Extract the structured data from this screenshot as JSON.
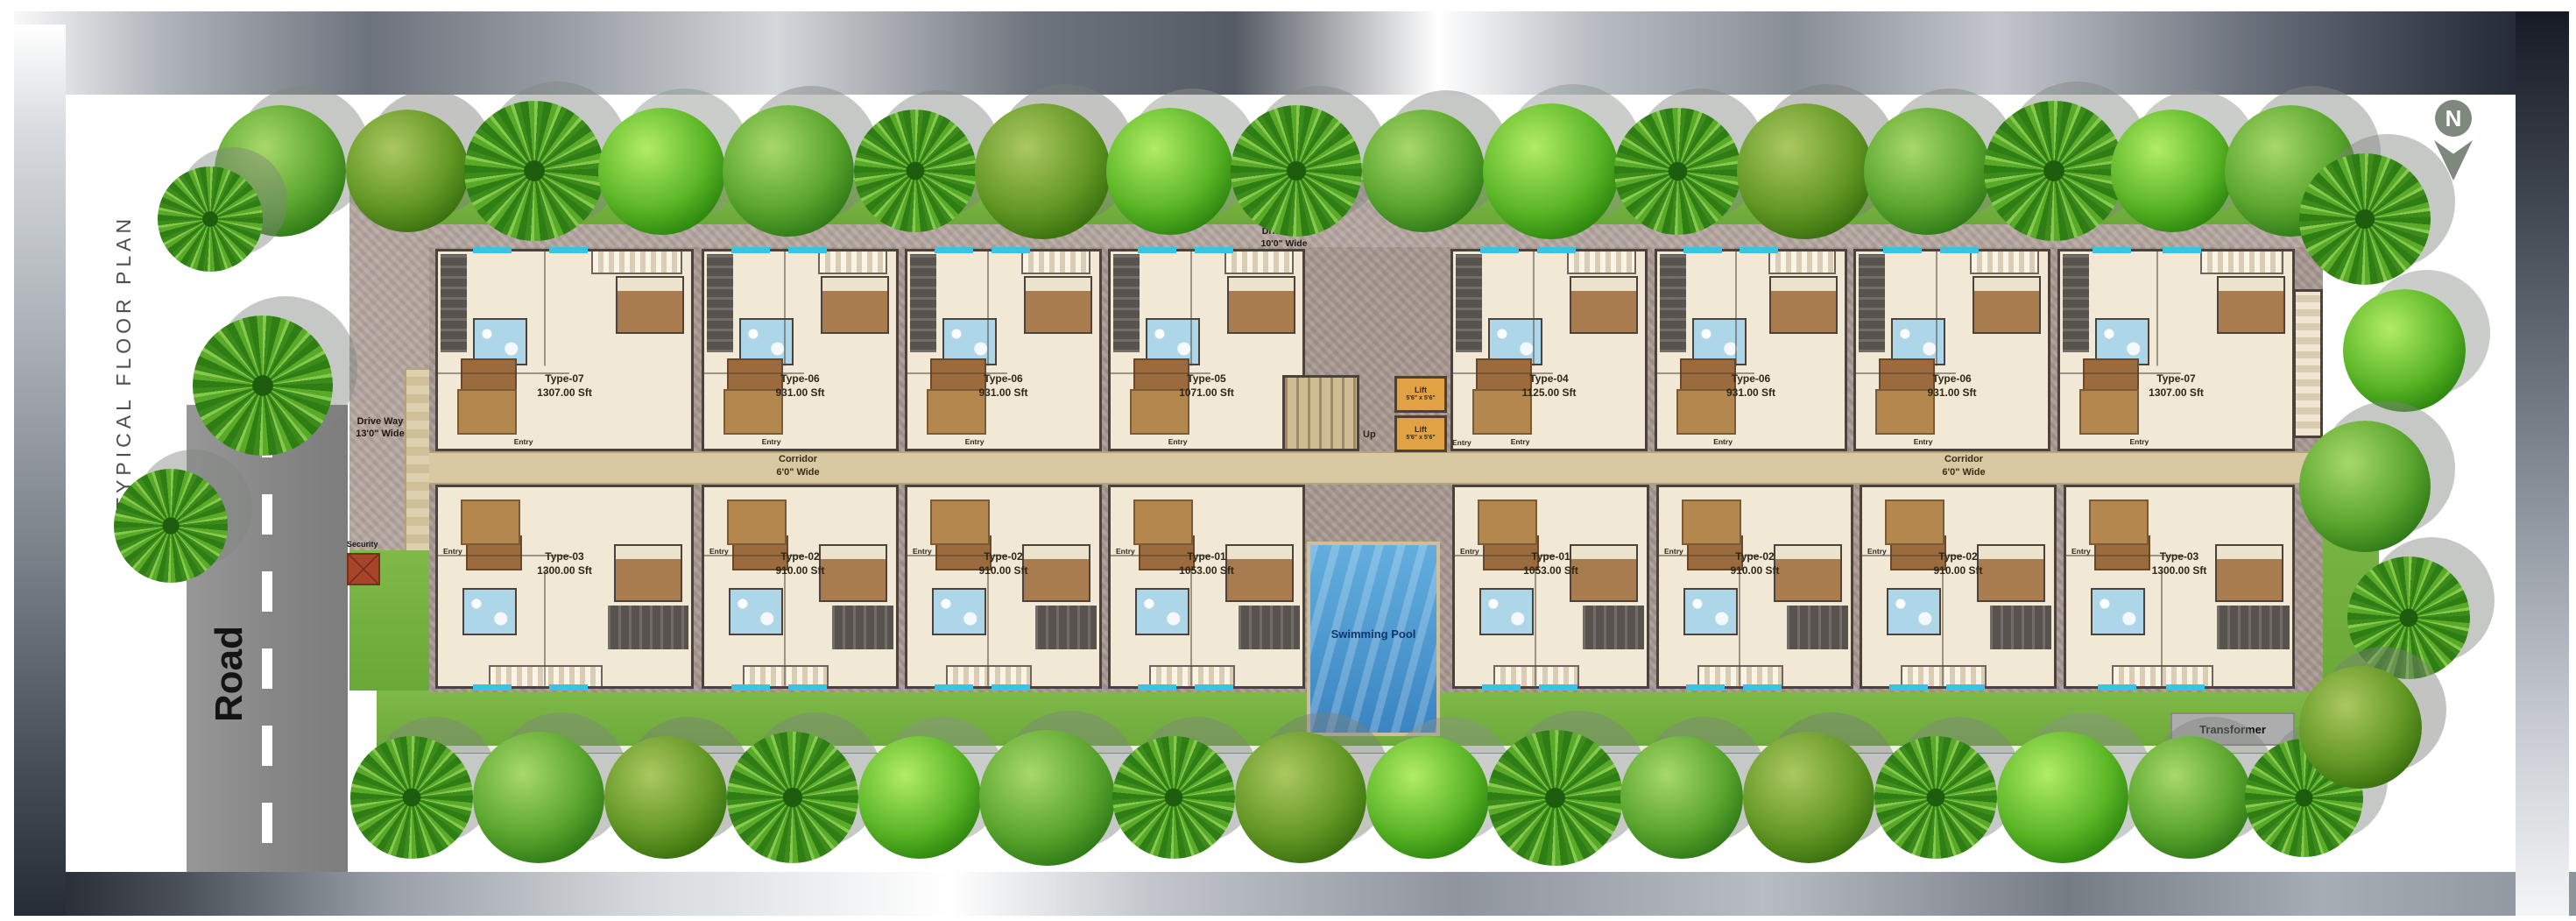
{
  "title": "TYPICAL FLOOR PLAN",
  "compass": {
    "label": "N"
  },
  "road": {
    "label": "Road"
  },
  "driveway_top": {
    "line1": "Drive Way",
    "line2": "10'0\" Wide"
  },
  "driveway_left": {
    "line1": "Drive Way",
    "line2": "13'0\" Wide"
  },
  "corridor": {
    "line1": "Corridor",
    "line2": "6'0\" Wide"
  },
  "core": {
    "up": "Up",
    "lift_line1": "Lift",
    "lift_line2": "5'6\" x 5'6\""
  },
  "labels": {
    "entry": "Entry"
  },
  "amenities": {
    "swimming_pool": "Swimming Pool",
    "security": "Security",
    "transformer": "Transformer"
  },
  "units_top": [
    {
      "type": "Type-07",
      "area": "1307.00 Sft"
    },
    {
      "type": "Type-06",
      "area": "931.00 Sft"
    },
    {
      "type": "Type-06",
      "area": "931.00 Sft"
    },
    {
      "type": "Type-05",
      "area": "1071.00 Sft"
    },
    {
      "type": "Type-04",
      "area": "1125.00 Sft"
    },
    {
      "type": "Type-06",
      "area": "931.00 Sft"
    },
    {
      "type": "Type-06",
      "area": "931.00 Sft"
    },
    {
      "type": "Type-07",
      "area": "1307.00 Sft"
    }
  ],
  "units_bottom": [
    {
      "type": "Type-03",
      "area": "1300.00 Sft"
    },
    {
      "type": "Type-02",
      "area": "910.00 Sft"
    },
    {
      "type": "Type-02",
      "area": "910.00 Sft"
    },
    {
      "type": "Type-01",
      "area": "1053.00 Sft"
    },
    {
      "type": "Type-01",
      "area": "1053.00 Sft"
    },
    {
      "type": "Type-02",
      "area": "910.00 Sft"
    },
    {
      "type": "Type-02",
      "area": "910.00 Sft"
    },
    {
      "type": "Type-03",
      "area": "1300.00 Sft"
    }
  ],
  "colors": {
    "lawn": "#74ae41",
    "pool_water": "#4796cf",
    "lift": "#e1a245",
    "corridor": "#d9c9a3",
    "unit_floor": "#f1e8d5",
    "road": "#8c8c8c",
    "driveway": "#b7a9a3",
    "pool_text": "#13356e"
  }
}
